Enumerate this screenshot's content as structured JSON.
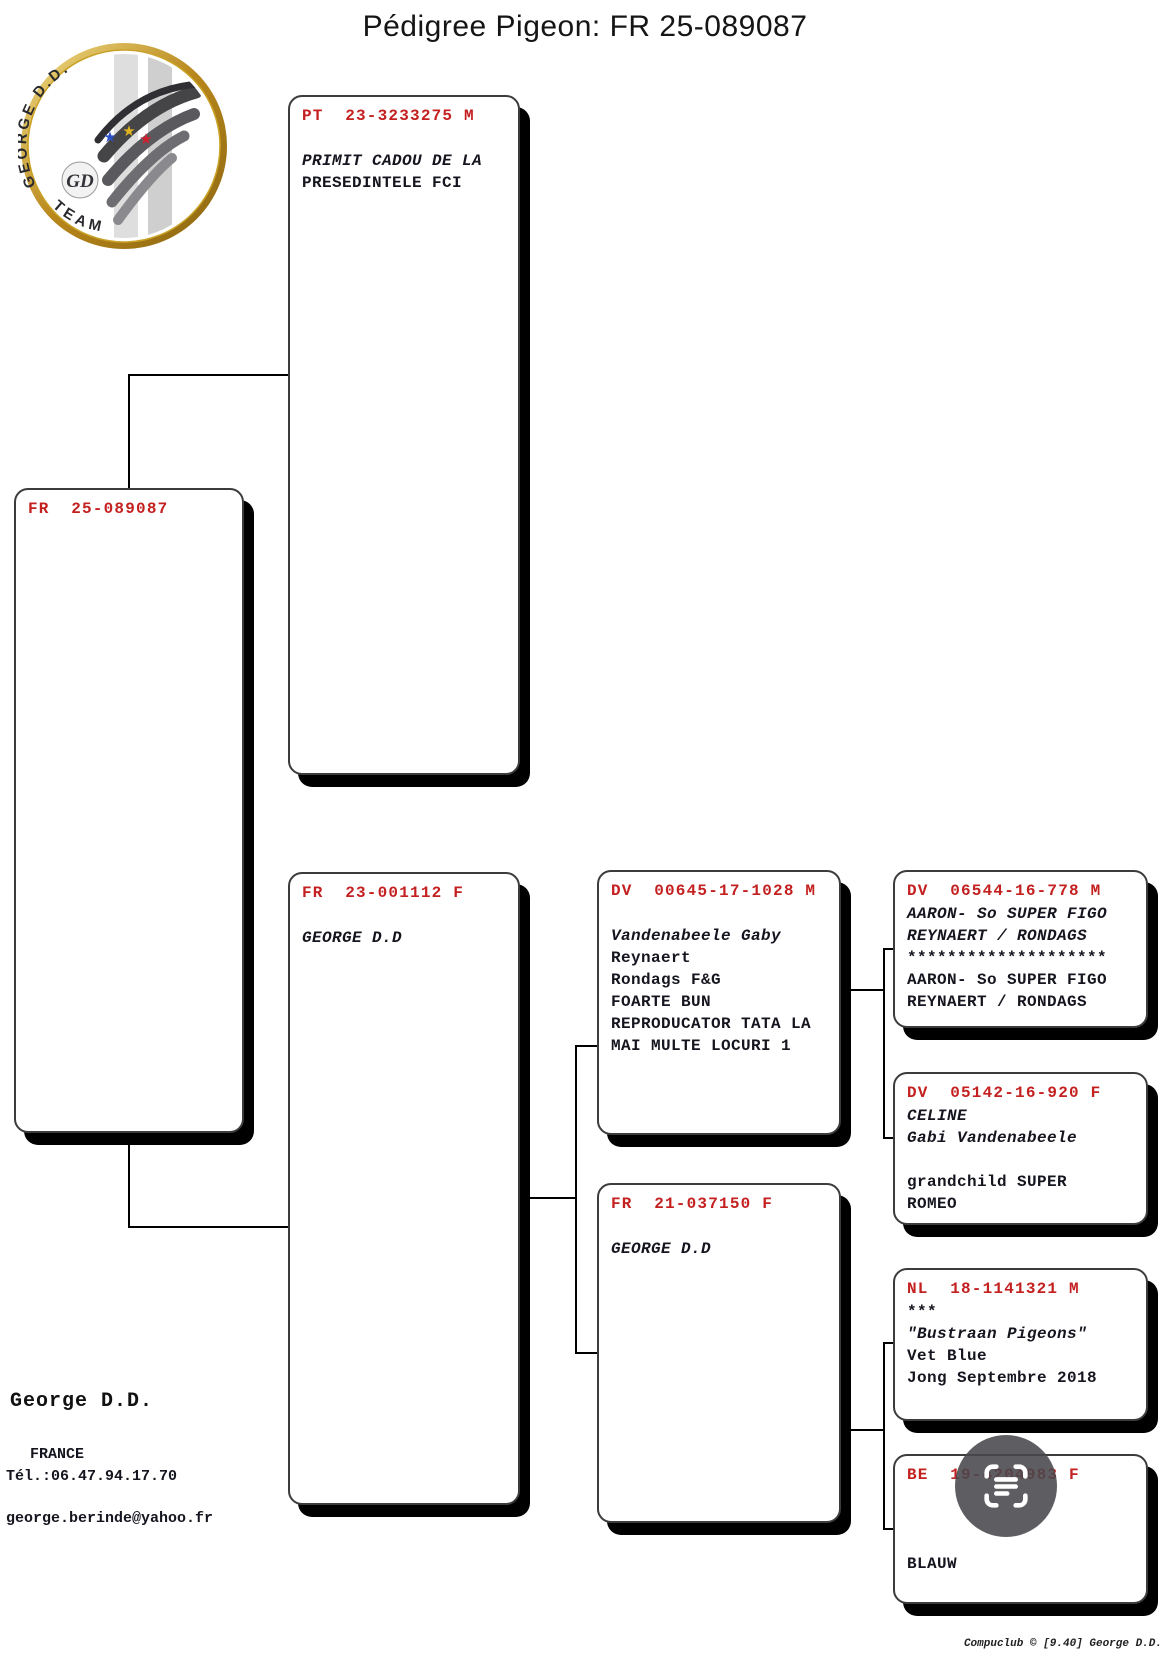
{
  "title": "Pédigree Pigeon: FR  25-089087",
  "logo": {
    "arc_top": "GEORGE D.D.",
    "arc_bottom": "TEAM",
    "monogram": "GD",
    "star_glyph": "★",
    "star_colors": [
      "#2b50c8",
      "#e0b420",
      "#cf2030"
    ]
  },
  "boxes": {
    "subject": {
      "ring": "FR  25-089087",
      "lines": []
    },
    "sire": {
      "ring": "PT  23-3233275 M",
      "lines": [
        "",
        "PRIMIT CADOU DE LA",
        "PRESEDINTELE FCI"
      ]
    },
    "dam": {
      "ring": "FR  23-001112 F",
      "lines": [
        "",
        "GEORGE D.D"
      ]
    },
    "dam_sire": {
      "ring": "DV  00645-17-1028 M",
      "lines": [
        "",
        "Vandenabeele Gaby",
        "Reynaert",
        "Rondags F&G",
        "FOARTE BUN",
        "REPRODUCATOR TATA LA",
        "MAI MULTE LOCURI 1"
      ]
    },
    "dam_dam": {
      "ring": "FR  21-037150 F",
      "lines": [
        "",
        "GEORGE D.D"
      ]
    },
    "dam_sire_sire": {
      "ring": "DV  06544-16-778 M",
      "lines": [
        "AARON- So SUPER FIGO",
        "REYNAERT / RONDAGS",
        "********************",
        "AARON- So SUPER FIGO",
        "REYNAERT / RONDAGS"
      ]
    },
    "dam_sire_dam": {
      "ring": "DV  05142-16-920 F",
      "lines": [
        "CELINE",
        "Gabi Vandenabeele",
        "",
        "grandchild SUPER",
        "ROMEO"
      ]
    },
    "dam_dam_sire": {
      "ring": "NL  18-1141321 M",
      "lines": [
        "***",
        "\"Bustraan Pigeons\"",
        "Vet Blue",
        "Jong Septembre 2018"
      ]
    },
    "dam_dam_dam": {
      "ring": "BE  19-4204983 F",
      "lines": [
        "",
        "",
        "",
        "BLAUW"
      ]
    }
  },
  "owner": {
    "name": "George D.D.",
    "country": "FRANCE",
    "phone": "Tél.:06.47.94.17.70",
    "email": "george.berinde@yahoo.fr"
  },
  "footer": {
    "credit": "Compuclub ©  [9.40]   George D.D."
  },
  "colors": {
    "ring_red": "#c42020",
    "ink": "#15151f",
    "shadow": "#000000"
  }
}
